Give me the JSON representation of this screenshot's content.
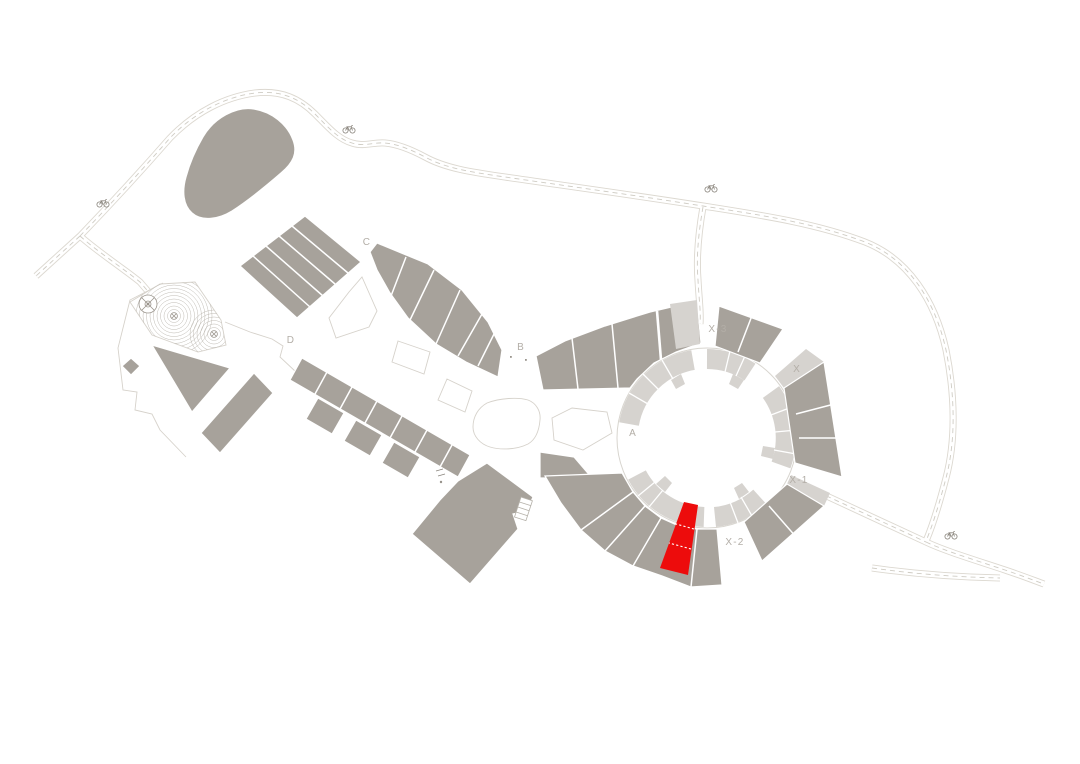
{
  "map": {
    "type": "architectural-site-plan",
    "background": "#ffffff",
    "colors": {
      "building": "#a7a29b",
      "building_light": "#d6d3cf",
      "highlight_red": "#ed0c0c",
      "road_edge": "#dcd8d0",
      "road_dash": "#cfccc4",
      "outline": "#d6d2cb",
      "label_text": "#b3aea7",
      "contour": "#b8b3ab",
      "icon": "#8a857d"
    },
    "zone_labels": {
      "A": "A",
      "B": "B",
      "C": "C",
      "D": "D",
      "X": "X",
      "X1": "X-1",
      "X2": "X-2",
      "X3": "X-3"
    },
    "highlighted_unit": {
      "color": "#ed0c0c",
      "near_zone": "X-2"
    },
    "bicycle_icon_count": 4
  }
}
